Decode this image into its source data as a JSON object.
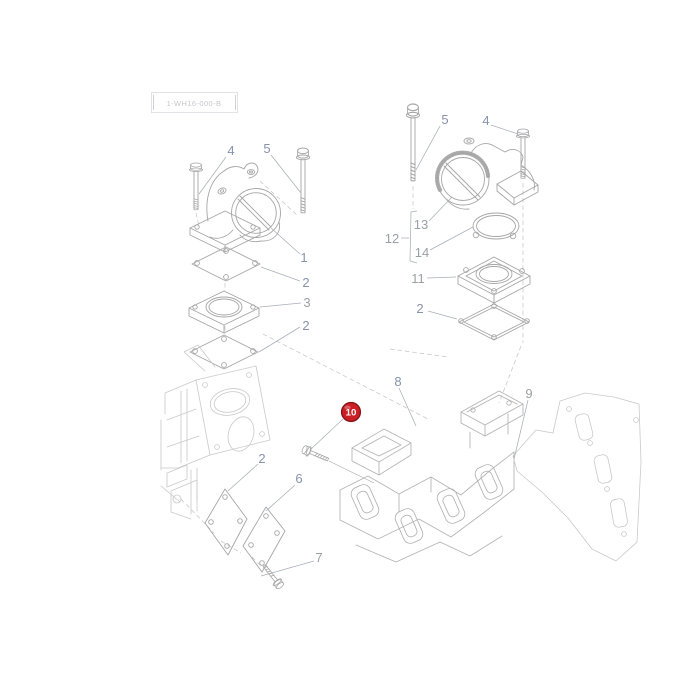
{
  "page": {
    "background": "#ffffff",
    "drawing_ref": "1-WH16-000-B"
  },
  "colors": {
    "line": "#a6a6a6",
    "line_light": "#c9c9c9",
    "label_blue": "#8792ac",
    "label_gray": "#9aa0a8",
    "badge_fill": "#cb1f27",
    "badge_border": "#8a1417",
    "badge_text": "#ffffff"
  },
  "callouts": {
    "left_bolt_4": "4",
    "left_bolt_5": "5",
    "intake_elbow_1": "1",
    "gasket_2a": "2",
    "spacer_3": "3",
    "gasket_2b": "2",
    "right_bolt_5": "5",
    "right_bolt_4": "4",
    "throttle_body_13": "13",
    "assembly_12": "12",
    "oring_14": "14",
    "flange_11": "11",
    "gasket_2c": "2",
    "manifold_8": "8",
    "manifold_gasket_9": "9",
    "highlighted_bolt_10": "10",
    "gasket_2d": "2",
    "cover_plate_6": "6",
    "bolt_7": "7"
  }
}
